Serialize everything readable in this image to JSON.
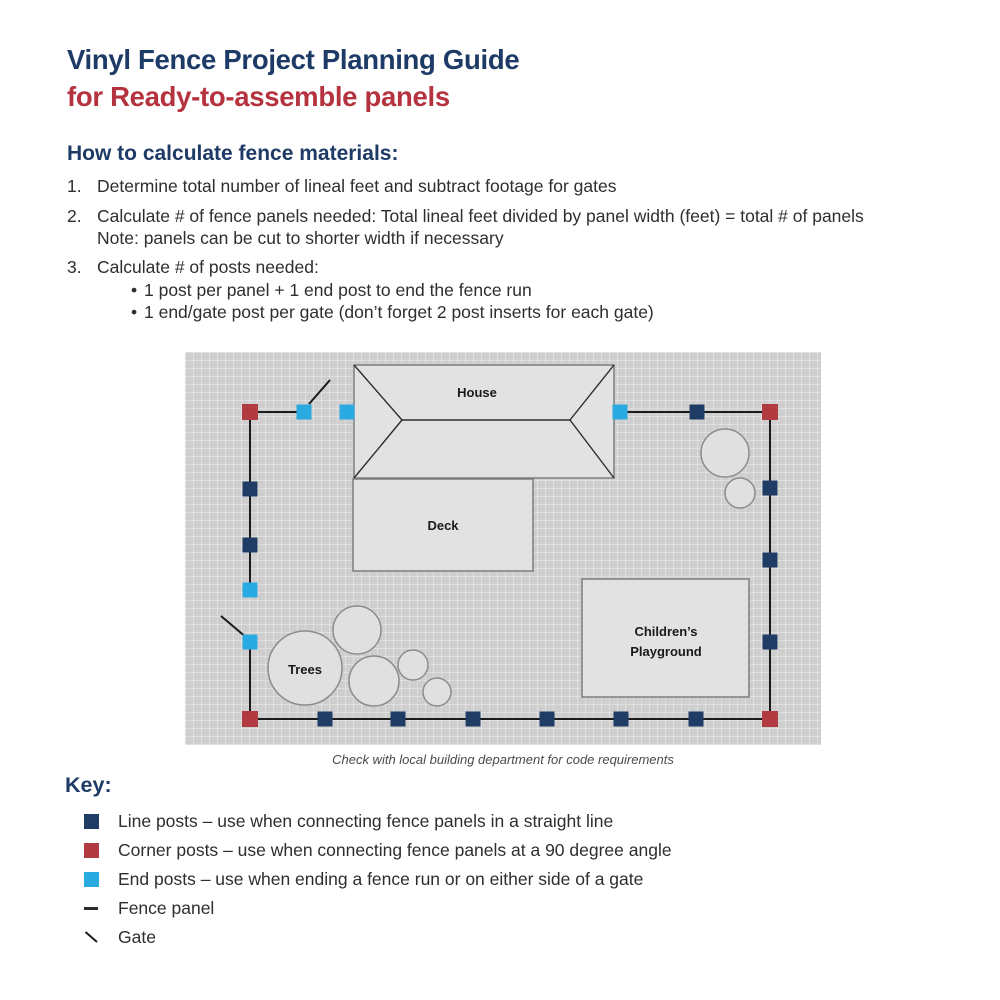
{
  "header": {
    "title": "Vinyl Fence Project Planning Guide",
    "subtitle": "for Ready-to-assemble panels"
  },
  "colors": {
    "title_navy": "#1e3a66",
    "title_red": "#b5333f",
    "line_post": "#1f3c64",
    "corner_post": "#b23b42",
    "end_post": "#29abe2"
  },
  "instructions": {
    "heading": "How to calculate fence materials:",
    "bullet_glyph": "•",
    "items": [
      {
        "number": "1.",
        "text": "Determine total number of lineal feet and subtract footage for gates"
      },
      {
        "number": "2.",
        "text": "Calculate # of fence panels needed: Total lineal feet divided by panel width (feet) = total # of panels",
        "note": "Note: panels can be cut to shorter width if necessary"
      },
      {
        "number": "3.",
        "text": "Calculate # of posts needed:",
        "bullets": [
          "1 post per panel + 1 end post to end the fence run",
          "1 end/gate post per gate (don’t forget 2 post inserts for each gate)"
        ]
      }
    ]
  },
  "diagram": {
    "caption": "Check with local building department for code requirements",
    "viewbox": "185 352 636 393",
    "colors": {
      "line": "#1f3c64",
      "corner": "#b23b42",
      "end": "#29abe2"
    },
    "post_size": 15,
    "post_size_corner": 16,
    "house": {
      "x": 354,
      "y": 365,
      "w": 260,
      "h": 113,
      "roof": [
        [
          354,
          365,
          402,
          420
        ],
        [
          354,
          478,
          402,
          420
        ],
        [
          402,
          420,
          570,
          420
        ],
        [
          614,
          365,
          570,
          420
        ],
        [
          614,
          478,
          570,
          420
        ]
      ]
    },
    "rects": [
      {
        "name": "deck",
        "x": 353,
        "y": 479,
        "w": 180,
        "h": 92
      },
      {
        "name": "playground",
        "x": 582,
        "y": 579,
        "w": 167,
        "h": 118
      }
    ],
    "circles": [
      {
        "name": "tree",
        "cx": 357,
        "cy": 630,
        "r": 24
      },
      {
        "name": "tree",
        "cx": 374,
        "cy": 681,
        "r": 25
      },
      {
        "name": "tree",
        "cx": 413,
        "cy": 665,
        "r": 15
      },
      {
        "name": "tree",
        "cx": 437,
        "cy": 692,
        "r": 14
      },
      {
        "name": "tree",
        "cx": 305,
        "cy": 668,
        "r": 37
      },
      {
        "name": "tree",
        "cx": 725,
        "cy": 453,
        "r": 24
      },
      {
        "name": "tree",
        "cx": 740,
        "cy": 493,
        "r": 15
      }
    ],
    "fence_segments": [
      [
        250,
        412,
        304,
        412
      ],
      [
        620,
        412,
        770,
        412
      ],
      [
        250,
        412,
        250,
        590
      ],
      [
        250,
        642,
        250,
        719
      ],
      [
        250,
        719,
        770,
        719
      ],
      [
        770,
        412,
        770,
        719
      ]
    ],
    "gate_lines": [
      [
        309,
        404,
        330,
        380
      ],
      [
        221,
        616,
        247,
        638
      ]
    ],
    "posts": [
      {
        "type": "corner",
        "x": 250,
        "y": 412
      },
      {
        "type": "end",
        "x": 304,
        "y": 412
      },
      {
        "type": "end",
        "x": 347,
        "y": 412
      },
      {
        "type": "end",
        "x": 620,
        "y": 412
      },
      {
        "type": "line",
        "x": 697,
        "y": 412
      },
      {
        "type": "corner",
        "x": 770,
        "y": 412
      },
      {
        "type": "line",
        "x": 250,
        "y": 489
      },
      {
        "type": "line",
        "x": 250,
        "y": 545
      },
      {
        "type": "end",
        "x": 250,
        "y": 590
      },
      {
        "type": "end",
        "x": 250,
        "y": 642
      },
      {
        "type": "line",
        "x": 770,
        "y": 488
      },
      {
        "type": "line",
        "x": 770,
        "y": 560
      },
      {
        "type": "line",
        "x": 770,
        "y": 642
      },
      {
        "type": "corner",
        "x": 250,
        "y": 719
      },
      {
        "type": "line",
        "x": 325,
        "y": 719
      },
      {
        "type": "line",
        "x": 398,
        "y": 719
      },
      {
        "type": "line",
        "x": 473,
        "y": 719
      },
      {
        "type": "line",
        "x": 547,
        "y": 719
      },
      {
        "type": "line",
        "x": 621,
        "y": 719
      },
      {
        "type": "line",
        "x": 696,
        "y": 719
      },
      {
        "type": "corner",
        "x": 770,
        "y": 719
      }
    ],
    "labels": [
      {
        "text": "House",
        "x": 477,
        "y": 397
      },
      {
        "text": "Deck",
        "x": 443,
        "y": 530
      },
      {
        "text": "Trees",
        "x": 305,
        "y": 674
      },
      {
        "text": "Children’s",
        "x": 666,
        "y": 636
      },
      {
        "text": "Playground",
        "x": 666,
        "y": 656
      }
    ]
  },
  "key": {
    "heading": "Key:",
    "items": [
      {
        "symbol": "line-post",
        "label": "Line posts – use when connecting fence panels in a straight line"
      },
      {
        "symbol": "corner-post",
        "label": "Corner posts – use when connecting fence panels at a 90 degree angle"
      },
      {
        "symbol": "end-post",
        "label": "End posts – use when ending a fence run or on either side of a gate"
      },
      {
        "symbol": "fence-panel",
        "label": "Fence panel"
      },
      {
        "symbol": "gate",
        "label": "Gate"
      }
    ]
  }
}
